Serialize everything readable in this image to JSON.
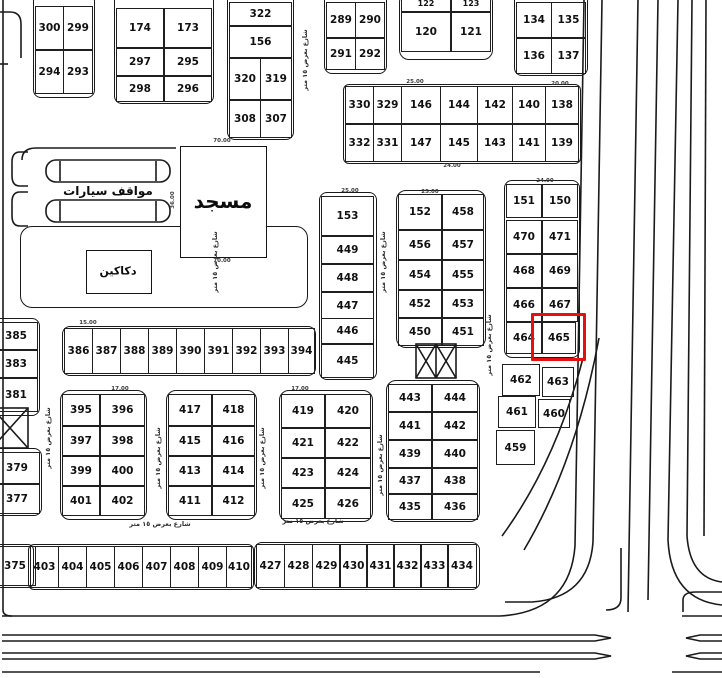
{
  "map_title": "residential-subdivision-plot-map",
  "highlight": {
    "plot": "465",
    "box": [
      531,
      313,
      49,
      42
    ],
    "color": "#e51010"
  },
  "line_color": "#1a1a1a",
  "areas": [
    {
      "name": "mosque",
      "label": "مسجد",
      "box": [
        180,
        146,
        85,
        110
      ],
      "pos": [
        223,
        201
      ],
      "font": 20
    },
    {
      "name": "car-parking",
      "label": "مواقف سيارات",
      "box": null,
      "pos": [
        108,
        191
      ],
      "font": 12
    },
    {
      "name": "shops",
      "label": "دكاكين",
      "box": [
        86,
        250,
        64,
        42
      ],
      "pos": [
        118,
        271
      ],
      "font": 11
    }
  ],
  "blocks": [
    [
      33,
      -8,
      60,
      104,
      8
    ],
    [
      114,
      -8,
      98,
      110,
      8
    ],
    [
      227,
      -8,
      65,
      146,
      8
    ],
    [
      324,
      -8,
      61,
      80,
      8
    ],
    [
      399,
      -8,
      92,
      66,
      10
    ],
    [
      514,
      -8,
      72,
      82,
      8
    ],
    [
      343,
      84,
      236,
      78,
      6
    ],
    [
      504,
      180,
      74,
      176,
      8
    ],
    [
      319,
      192,
      56,
      186,
      8
    ],
    [
      396,
      190,
      88,
      156,
      10
    ],
    [
      -8,
      318,
      46,
      96,
      8
    ],
    [
      -8,
      448,
      48,
      66,
      8
    ],
    [
      -8,
      544,
      40,
      42,
      6
    ],
    [
      62,
      326,
      252,
      48,
      8
    ],
    [
      60,
      390,
      85,
      128,
      10
    ],
    [
      166,
      390,
      89,
      128,
      10
    ],
    [
      279,
      390,
      92,
      130,
      10
    ],
    [
      386,
      380,
      92,
      140,
      10
    ],
    [
      28,
      544,
      224,
      44,
      6
    ],
    [
      254,
      542,
      224,
      46,
      8
    ],
    [
      20,
      226,
      286,
      80,
      12
    ]
  ],
  "plots": [
    [
      "300",
      35,
      6,
      27,
      42
    ],
    [
      "299",
      63,
      6,
      28,
      42
    ],
    [
      "294",
      35,
      50,
      27,
      42
    ],
    [
      "293",
      63,
      50,
      28,
      42
    ],
    [
      "174",
      116,
      8,
      46,
      38
    ],
    [
      "173",
      164,
      8,
      46,
      38
    ],
    [
      "297",
      116,
      48,
      46,
      26
    ],
    [
      "295",
      164,
      48,
      46,
      26
    ],
    [
      "298",
      116,
      76,
      46,
      24
    ],
    [
      "296",
      164,
      76,
      46,
      24
    ],
    [
      "322",
      229,
      2,
      61,
      22
    ],
    [
      "156",
      229,
      26,
      61,
      30
    ],
    [
      "320",
      229,
      58,
      30,
      40
    ],
    [
      "319",
      260,
      58,
      30,
      40
    ],
    [
      "308",
      229,
      100,
      30,
      36
    ],
    [
      "307",
      260,
      100,
      30,
      36
    ],
    [
      "289",
      326,
      2,
      28,
      34
    ],
    [
      "290",
      355,
      2,
      28,
      34
    ],
    [
      "291",
      326,
      38,
      28,
      30
    ],
    [
      "292",
      355,
      38,
      28,
      30
    ],
    [
      "122",
      401,
      -6,
      48,
      16
    ],
    [
      "123",
      451,
      -6,
      38,
      16
    ],
    [
      "120",
      401,
      12,
      48,
      38
    ],
    [
      "121",
      451,
      12,
      38,
      38
    ],
    [
      "134",
      516,
      2,
      34,
      34
    ],
    [
      "135",
      551,
      2,
      33,
      34
    ],
    [
      "136",
      516,
      38,
      34,
      34
    ],
    [
      "137",
      551,
      38,
      33,
      34
    ],
    [
      "330",
      345,
      86,
      27,
      36
    ],
    [
      "329",
      373,
      86,
      27,
      36
    ],
    [
      "146",
      401,
      86,
      38,
      36
    ],
    [
      "144",
      440,
      86,
      36,
      36
    ],
    [
      "142",
      477,
      86,
      34,
      36
    ],
    [
      "140",
      512,
      86,
      32,
      36
    ],
    [
      "138",
      545,
      86,
      32,
      36
    ],
    [
      "332",
      345,
      124,
      27,
      36
    ],
    [
      "331",
      373,
      124,
      27,
      36
    ],
    [
      "147",
      401,
      124,
      38,
      36
    ],
    [
      "145",
      440,
      124,
      36,
      36
    ],
    [
      "143",
      477,
      124,
      34,
      36
    ],
    [
      "141",
      512,
      124,
      32,
      36
    ],
    [
      "139",
      545,
      124,
      32,
      36
    ],
    [
      "151",
      506,
      184,
      34,
      32
    ],
    [
      "150",
      542,
      184,
      34,
      32
    ],
    [
      "470",
      506,
      220,
      34,
      32
    ],
    [
      "471",
      542,
      220,
      34,
      32
    ],
    [
      "468",
      506,
      254,
      34,
      32
    ],
    [
      "469",
      542,
      254,
      34,
      32
    ],
    [
      "466",
      506,
      288,
      34,
      32
    ],
    [
      "467",
      542,
      288,
      34,
      32
    ],
    [
      "464",
      506,
      322,
      34,
      30
    ],
    [
      "465",
      542,
      322,
      32,
      30
    ],
    [
      "462",
      502,
      364,
      36,
      30
    ],
    [
      "463",
      542,
      367,
      30,
      28
    ],
    [
      "461",
      498,
      396,
      36,
      30
    ],
    [
      "460",
      538,
      399,
      30,
      27
    ],
    [
      "459",
      496,
      430,
      37,
      33
    ],
    [
      "153",
      321,
      196,
      51,
      38
    ],
    [
      "449",
      321,
      236,
      51,
      26
    ],
    [
      "448",
      321,
      264,
      51,
      26
    ],
    [
      "447",
      321,
      292,
      51,
      25
    ],
    [
      "446",
      321,
      318,
      51,
      24
    ],
    [
      "445",
      321,
      344,
      51,
      32
    ],
    [
      "152",
      398,
      194,
      42,
      34
    ],
    [
      "458",
      442,
      194,
      40,
      34
    ],
    [
      "456",
      398,
      230,
      42,
      28
    ],
    [
      "457",
      442,
      230,
      40,
      28
    ],
    [
      "454",
      398,
      260,
      42,
      28
    ],
    [
      "455",
      442,
      260,
      40,
      28
    ],
    [
      "452",
      398,
      290,
      42,
      26
    ],
    [
      "453",
      442,
      290,
      40,
      26
    ],
    [
      "450",
      398,
      318,
      42,
      26
    ],
    [
      "451",
      442,
      318,
      40,
      26
    ],
    [
      "385",
      -6,
      322,
      42,
      26
    ],
    [
      "383",
      -6,
      350,
      42,
      26
    ],
    [
      "381",
      -6,
      378,
      42,
      32
    ],
    [
      "379",
      -6,
      452,
      44,
      30
    ],
    [
      "377",
      -6,
      484,
      44,
      28
    ],
    [
      "375",
      -6,
      546,
      40,
      38
    ],
    [
      "386",
      64,
      328,
      27,
      44
    ],
    [
      "387",
      92,
      328,
      27,
      44
    ],
    [
      "388",
      120,
      328,
      27,
      44
    ],
    [
      "389",
      148,
      328,
      27,
      44
    ],
    [
      "390",
      176,
      328,
      27,
      44
    ],
    [
      "391",
      204,
      328,
      27,
      44
    ],
    [
      "392",
      232,
      328,
      27,
      44
    ],
    [
      "393",
      260,
      328,
      27,
      44
    ],
    [
      "394",
      288,
      328,
      25,
      44
    ],
    [
      "395",
      62,
      394,
      36,
      30
    ],
    [
      "396",
      100,
      394,
      43,
      30
    ],
    [
      "397",
      62,
      426,
      36,
      28
    ],
    [
      "398",
      100,
      426,
      43,
      28
    ],
    [
      "399",
      62,
      456,
      36,
      28
    ],
    [
      "400",
      100,
      456,
      43,
      28
    ],
    [
      "401",
      62,
      486,
      36,
      28
    ],
    [
      "402",
      100,
      486,
      43,
      28
    ],
    [
      "417",
      168,
      394,
      42,
      30
    ],
    [
      "418",
      212,
      394,
      41,
      30
    ],
    [
      "415",
      168,
      426,
      42,
      28
    ],
    [
      "416",
      212,
      426,
      41,
      28
    ],
    [
      "413",
      168,
      456,
      42,
      28
    ],
    [
      "414",
      212,
      456,
      41,
      28
    ],
    [
      "411",
      168,
      486,
      42,
      28
    ],
    [
      "412",
      212,
      486,
      41,
      28
    ],
    [
      "419",
      281,
      394,
      42,
      32
    ],
    [
      "420",
      325,
      394,
      44,
      32
    ],
    [
      "421",
      281,
      428,
      42,
      28
    ],
    [
      "422",
      325,
      428,
      44,
      28
    ],
    [
      "423",
      281,
      458,
      42,
      28
    ],
    [
      "424",
      325,
      458,
      44,
      28
    ],
    [
      "425",
      281,
      488,
      42,
      29
    ],
    [
      "426",
      325,
      488,
      44,
      29
    ],
    [
      "443",
      388,
      384,
      42,
      26
    ],
    [
      "444",
      432,
      384,
      44,
      26
    ],
    [
      "441",
      388,
      412,
      42,
      26
    ],
    [
      "442",
      432,
      412,
      44,
      26
    ],
    [
      "439",
      388,
      440,
      42,
      26
    ],
    [
      "440",
      432,
      440,
      44,
      26
    ],
    [
      "437",
      388,
      468,
      42,
      24
    ],
    [
      "438",
      432,
      468,
      44,
      24
    ],
    [
      "435",
      388,
      494,
      42,
      24
    ],
    [
      "436",
      432,
      494,
      44,
      24
    ],
    [
      "403",
      30,
      546,
      27,
      40
    ],
    [
      "404",
      58,
      546,
      27,
      40
    ],
    [
      "405",
      86,
      546,
      27,
      40
    ],
    [
      "406",
      114,
      546,
      27,
      40
    ],
    [
      "407",
      142,
      546,
      27,
      40
    ],
    [
      "408",
      170,
      546,
      27,
      40
    ],
    [
      "409",
      198,
      546,
      27,
      40
    ],
    [
      "410",
      226,
      546,
      24,
      40
    ],
    [
      "427",
      256,
      544,
      27,
      42
    ],
    [
      "428",
      284,
      544,
      27,
      42
    ],
    [
      "429",
      312,
      544,
      27,
      42
    ],
    [
      "430",
      339,
      544,
      27,
      42
    ],
    [
      "431",
      366,
      544,
      27,
      42
    ],
    [
      "432",
      393,
      544,
      27,
      42
    ],
    [
      "433",
      420,
      544,
      27,
      42
    ],
    [
      "434",
      447,
      544,
      28,
      42
    ]
  ],
  "street_labels": [
    [
      "شارع بعرض ١٥ متر",
      215,
      262,
      "v"
    ],
    [
      "شارع بعرض ١٥ متر",
      383,
      262,
      "v"
    ],
    [
      "شارع بعرض ١٥ متر",
      489,
      345,
      "v"
    ],
    [
      "شارع بعرض ١٥ متر",
      48,
      438,
      "v"
    ],
    [
      "شارع بعرض ١٥ متر",
      158,
      458,
      "v"
    ],
    [
      "شارع بعرض ١٥ متر",
      262,
      458,
      "v"
    ],
    [
      "شارع بعرض ١٥ متر",
      380,
      465,
      "v"
    ],
    [
      "شارع بعرض ١٥ متر",
      305,
      60,
      "v"
    ],
    [
      "شارع بعرض ١٥ متر",
      313,
      521,
      "h"
    ],
    [
      "شارع بعرض ١٥ متر",
      160,
      524,
      "h"
    ]
  ],
  "dims": [
    [
      "70.00",
      222,
      141,
      0
    ],
    [
      "70.00",
      222,
      261,
      0
    ],
    [
      "36.00",
      173,
      200,
      90
    ],
    [
      "25.00",
      415,
      82,
      0
    ],
    [
      "24.00",
      452,
      166,
      0
    ],
    [
      "17.00",
      120,
      389,
      0
    ],
    [
      "15.00",
      88,
      323,
      0
    ],
    [
      "24.00",
      545,
      181,
      0
    ],
    [
      "25.00",
      350,
      191,
      0
    ],
    [
      "17.00",
      300,
      389,
      0
    ],
    [
      "20.00",
      560,
      84,
      0
    ],
    [
      "25.00",
      430,
      192,
      0
    ]
  ]
}
